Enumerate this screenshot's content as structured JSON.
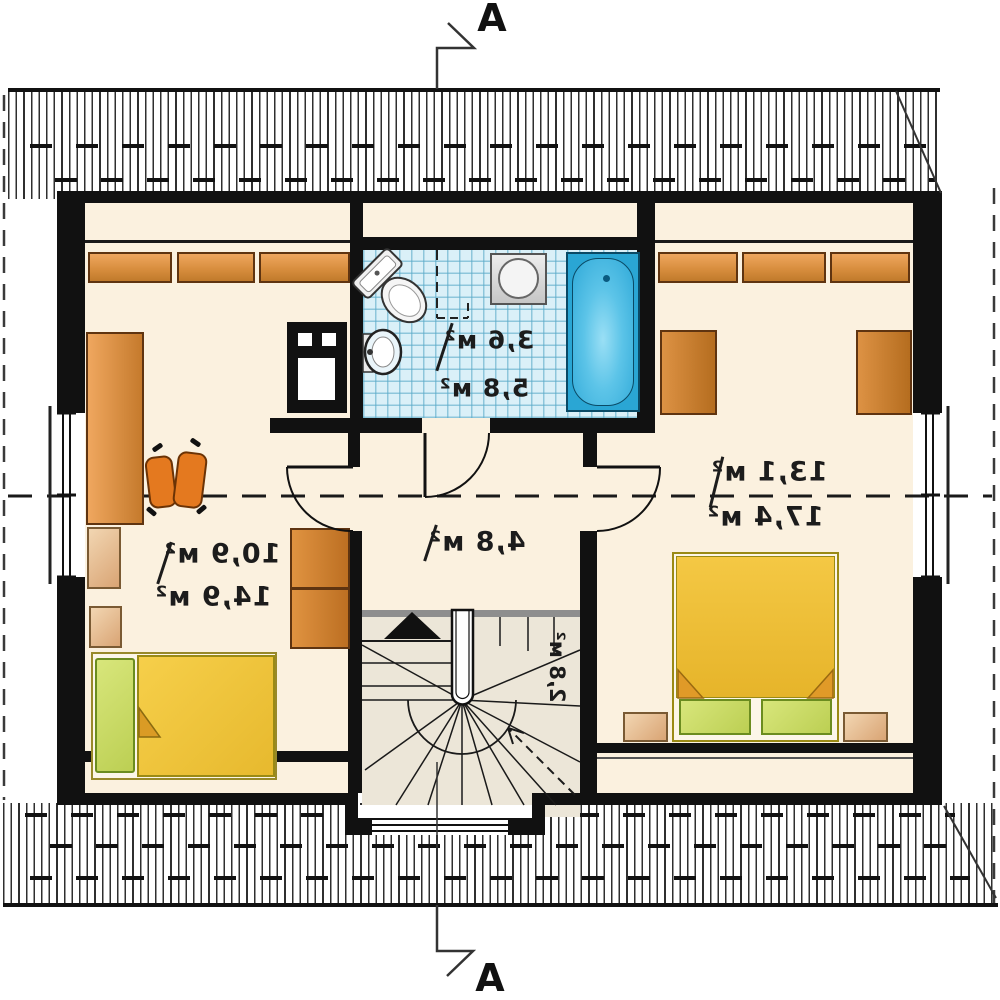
{
  "title": "attic floor plan",
  "section_marker": {
    "label": "A"
  },
  "rooms": {
    "bedroom_left": {
      "area_floor": "10,9 м²",
      "area_total": "14,9 м²"
    },
    "bathroom": {
      "area_floor": "3,6 м²",
      "area_total": "5,8 м²"
    },
    "hall": {
      "area_floor": "4,8 м²"
    },
    "staircase": {
      "area_floor": "2,8 м²"
    },
    "bedroom_right": {
      "area_floor": "13,1 м²",
      "area_total": "17,4 м²"
    }
  },
  "colors": {
    "wall": "#111111",
    "floor": "#FBF1DF",
    "tiles": "#DAF0F8",
    "wood": "#D98C3F",
    "bed_blanket": "#F0C23C",
    "pillow": "#CFE069",
    "bathtub": "#2AA6D4"
  }
}
